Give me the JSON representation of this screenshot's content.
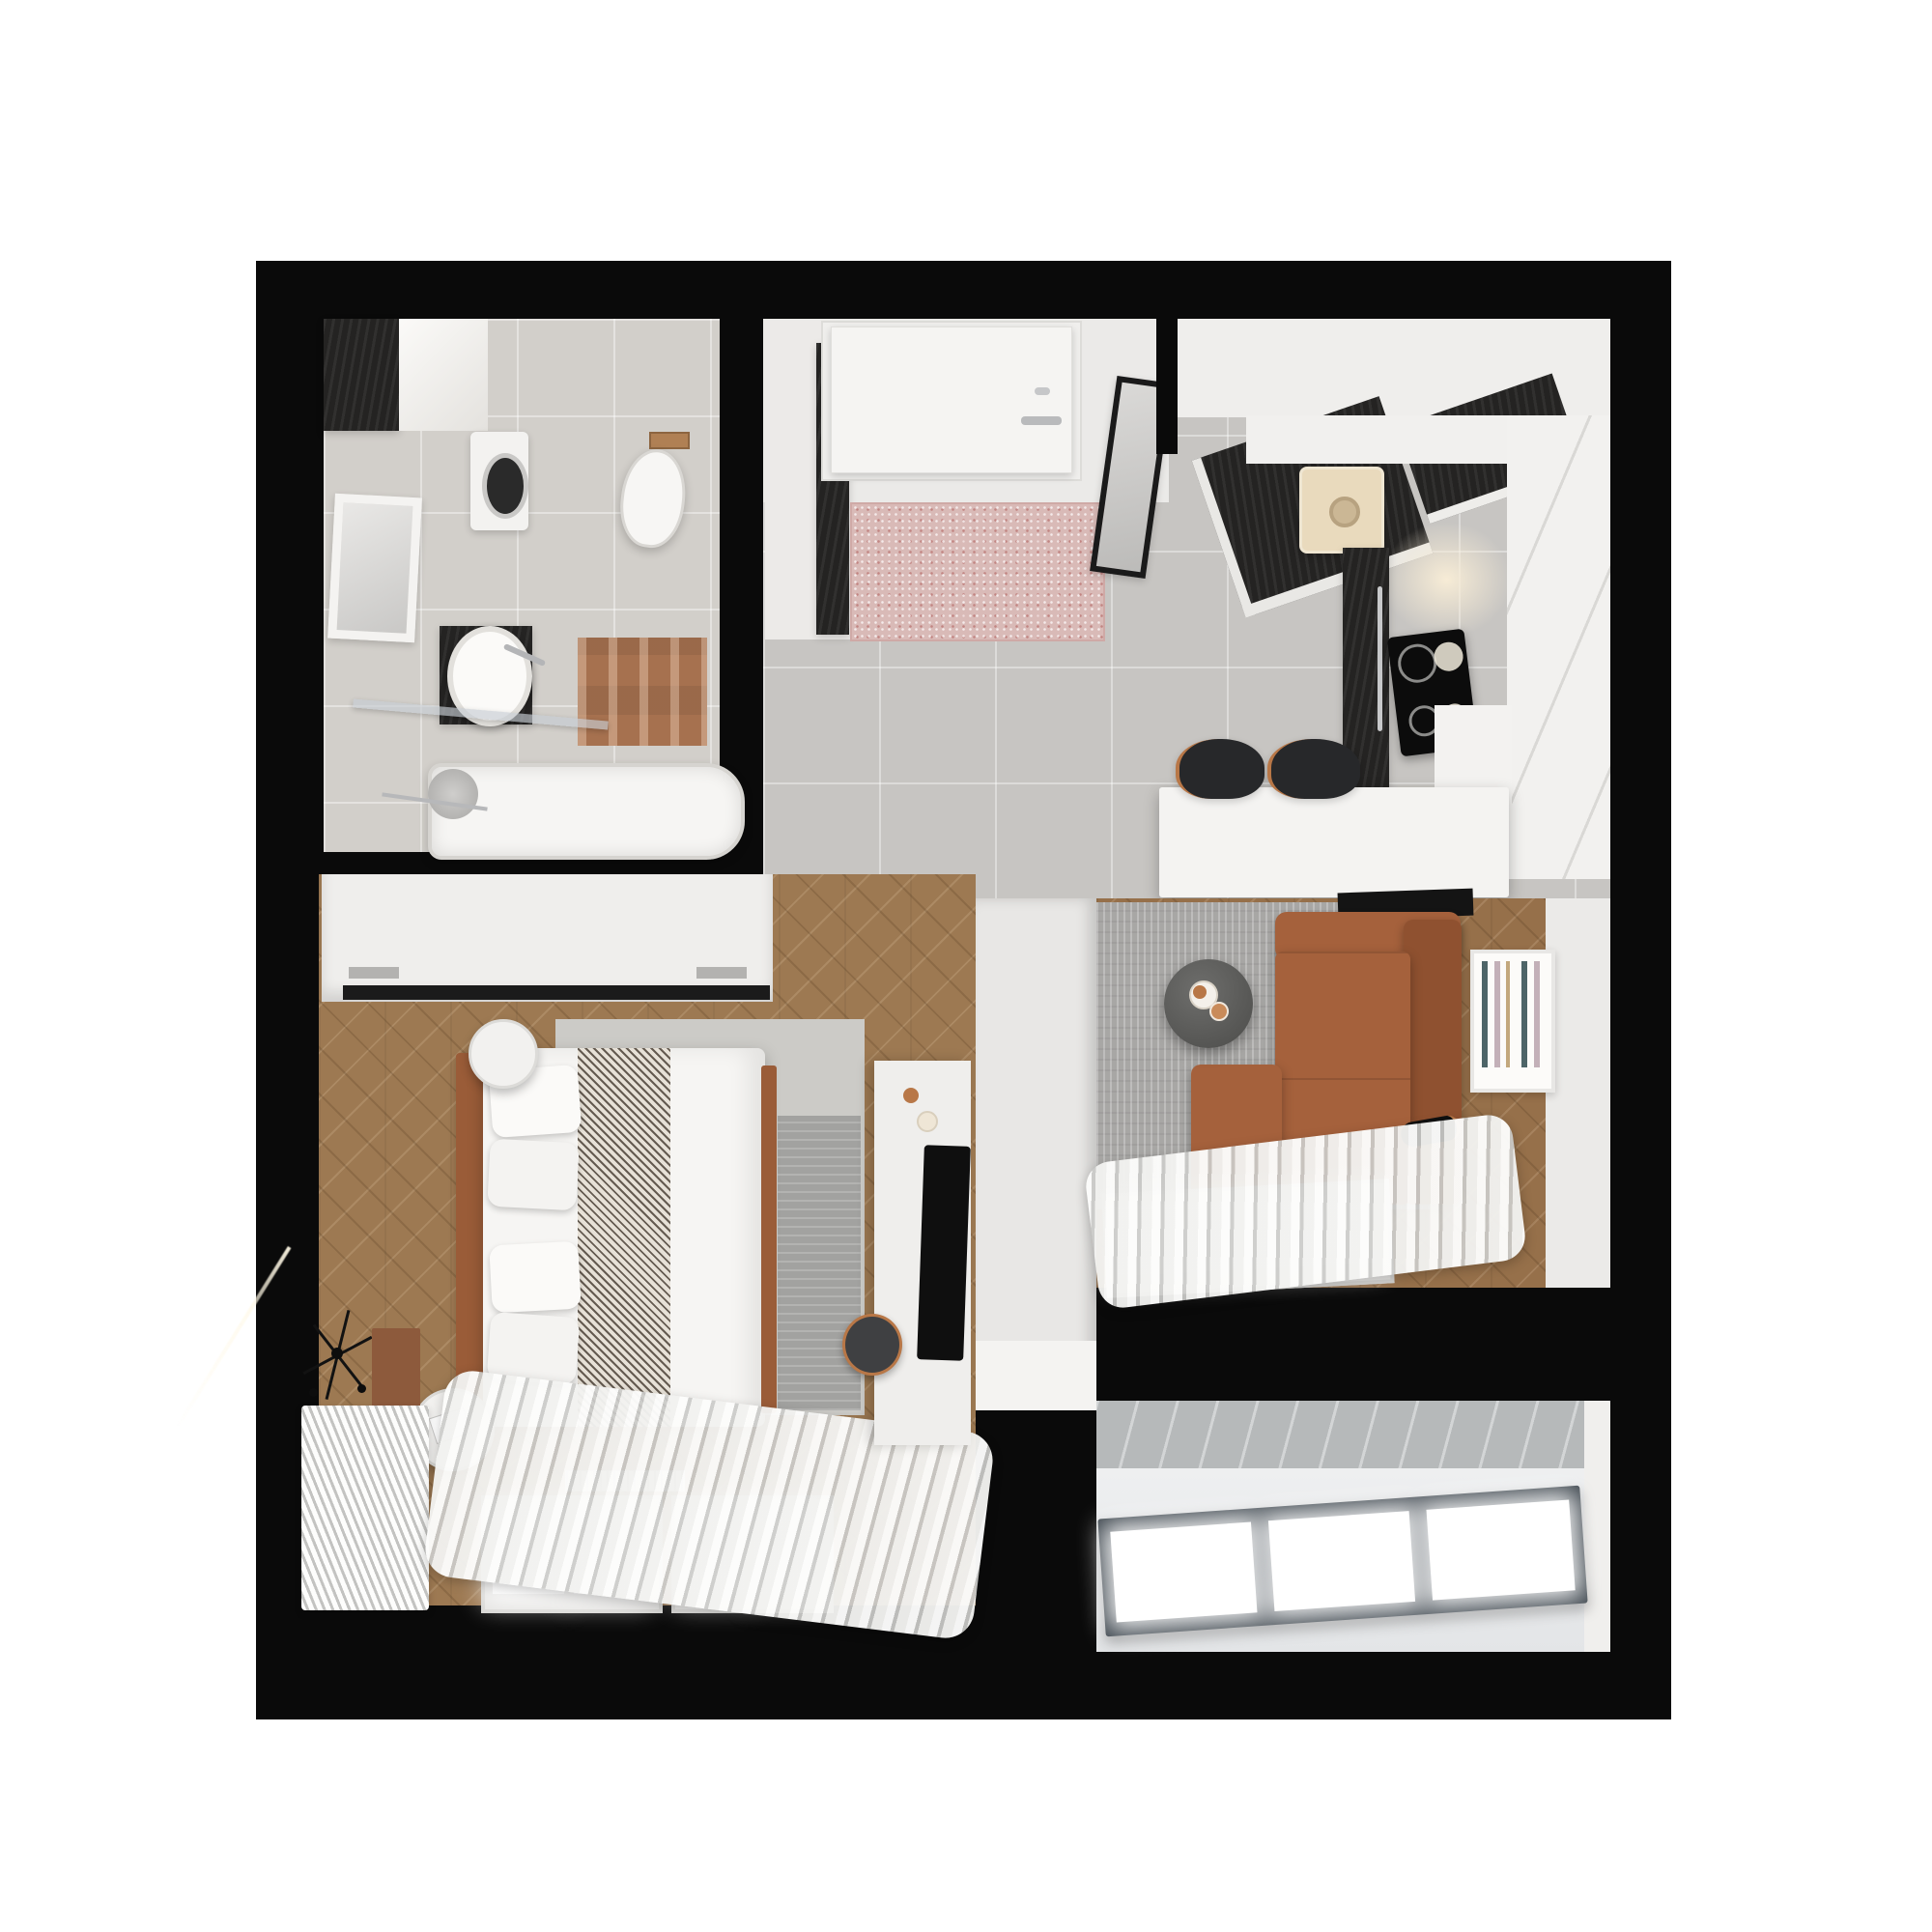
{
  "page": {
    "type": "3d-rendered-floor-plan",
    "description": "Top-down 3D render of a one-bedroom apartment floor plan on a white background"
  },
  "palette": {
    "page": "#ffffff",
    "wall": "#0a0a0a",
    "tile": "#c7c5c2",
    "bath-tile": "#d2cfca",
    "wood": "#9d7952",
    "wood-living": "#96704a",
    "white-f": "#f2f1ef",
    "dark-f": "#242322",
    "cream": "#e9dabd",
    "pink-mat": "#d9bab7",
    "bath-mat": "#a6714f",
    "sofa": "#a5613c",
    "sofa-dark": "#8f5130",
    "rug-living": "#a8a7a5",
    "rug-bedroom": "#cccbc7",
    "copper": "#b87747",
    "stool": "#27282a",
    "glass-frame": "#39424a",
    "glow": "#f7ecd6"
  },
  "rooms": [
    {
      "id": "bathroom",
      "name": "Bathroom",
      "furniture": [
        "dark wall cabinet",
        "washing machine",
        "wall-hung toilet",
        "framed mirror",
        "oval sink on dark vanity",
        "bathtub with glass screen",
        "brown bath mat"
      ]
    },
    {
      "id": "entry-hall",
      "name": "Entry hall",
      "furniture": [
        "front door",
        "pink speckled door mat",
        "dark-front wardrobe",
        "black framed mirror"
      ]
    },
    {
      "id": "kitchen",
      "name": "Kitchen",
      "furniture": [
        "dark angled base cabinets",
        "cream sink",
        "tall oven column",
        "black cooktop with four burners",
        "white counter with seams",
        "white bar island",
        "two dark bar stools with copper legs"
      ]
    },
    {
      "id": "living-room",
      "name": "Living room",
      "furniture": [
        "gray rug",
        "cognac leather L-sofa",
        "round dark coffee table",
        "wall art with vertical strokes",
        "black floor lamp",
        "dark media console",
        "sheer curtains",
        "windows"
      ]
    },
    {
      "id": "bedroom",
      "name": "Bedroom",
      "furniture": [
        "white wardrobe with dark rail",
        "double bed with herringbone throw",
        "four white pillows",
        "cognac headboard",
        "two round side tables",
        "white radiator",
        "window bay",
        "sheer curtains",
        "white media cabinet with TV",
        "dark stool",
        "black wall sconce",
        "floor vent"
      ]
    },
    {
      "id": "balcony",
      "name": "Balcony",
      "furniture": [
        "concrete sill strip",
        "dark framed glazing with three panes"
      ]
    }
  ]
}
